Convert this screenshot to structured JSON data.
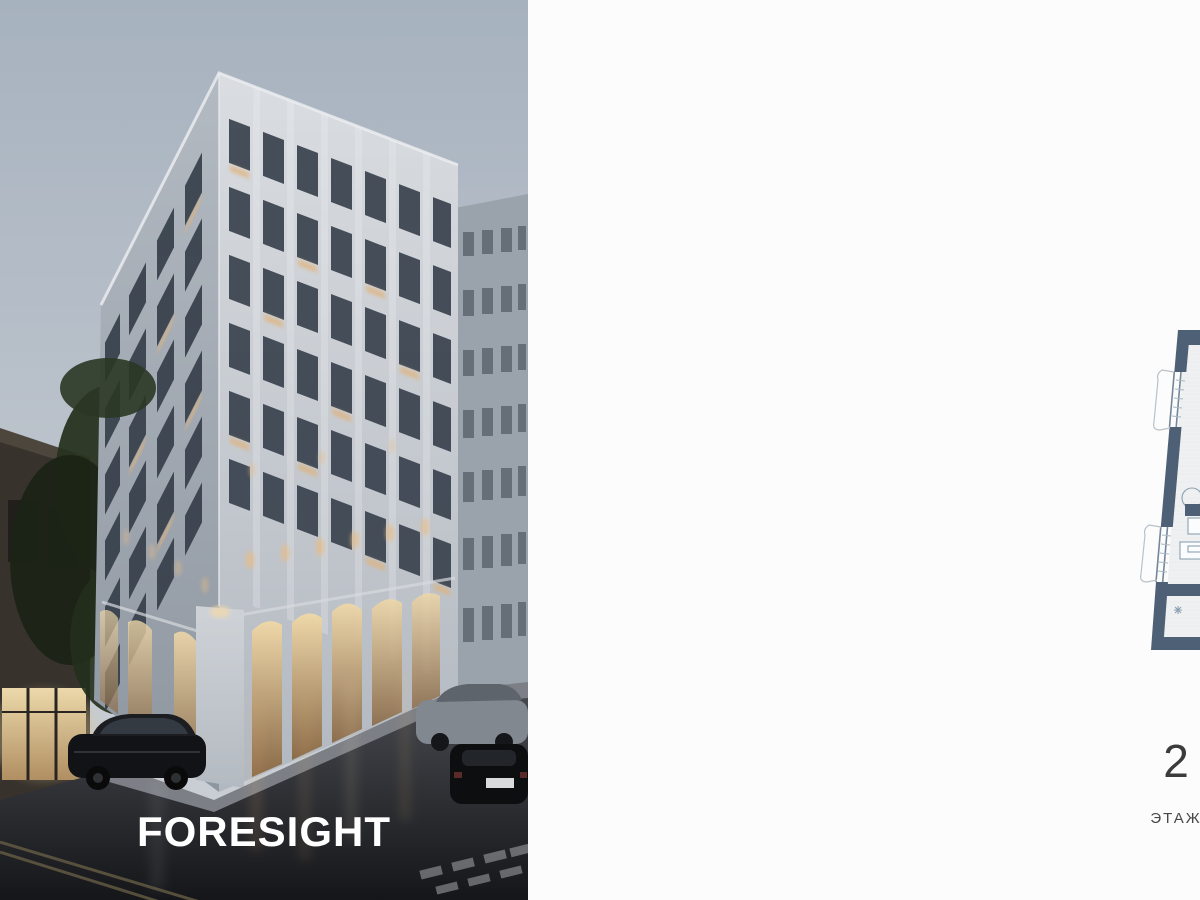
{
  "brand": {
    "monogram": "ДЗ",
    "wordmark": "ДОМ СОБОЛЕВА"
  },
  "photo": {
    "label": "FORESIGHT"
  },
  "compass": {
    "n": "С",
    "e": "В",
    "s": "Ю",
    "w": "З"
  },
  "floorplan": {
    "rooms": [
      {
        "name": "bedroom",
        "area": "16.89"
      },
      {
        "name": "living-room",
        "area": "20.92"
      },
      {
        "name": "kitchen-zone",
        "area": "6.16"
      },
      {
        "name": "wardrobe-right",
        "area": "1.93"
      },
      {
        "name": "laundry",
        "area": "2.43"
      },
      {
        "name": "bathroom",
        "area": "3.60"
      },
      {
        "name": "master-bath",
        "area": "7.77"
      },
      {
        "name": "corridor",
        "area": "6.57"
      },
      {
        "name": "hall-passage",
        "area": "4.60"
      },
      {
        "name": "entry-hall",
        "area": "10.70"
      }
    ]
  },
  "stats": {
    "floor": {
      "value": "2",
      "label": "ЭТАЖ"
    },
    "area": {
      "value": "81,57 м",
      "sup": "2",
      "label": "ПЛОЩАДЬ"
    },
    "bedrooms": {
      "value": "1",
      "label": "СПАЛЬНИ"
    }
  },
  "colors": {
    "plan_wall": "#4e6076",
    "plan_floor": "#eef0f1",
    "warm_light": "#dfb184",
    "brand_gray": "#8d8d8d"
  }
}
